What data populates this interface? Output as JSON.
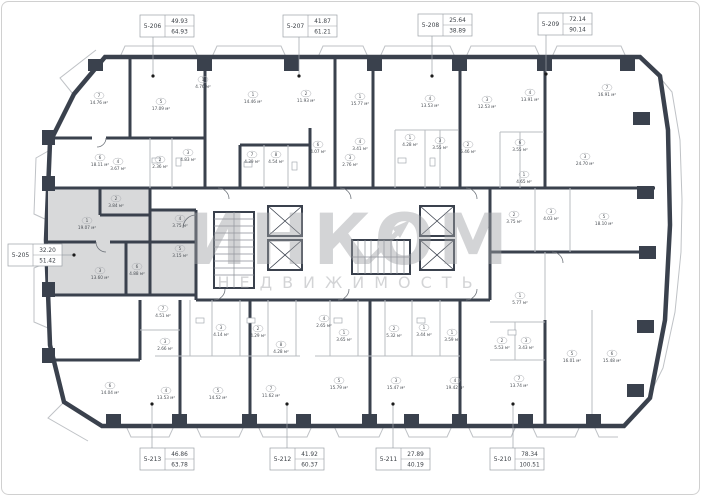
{
  "plan": {
    "area_unit": "м²",
    "watermark": {
      "title": "ИНКОМ",
      "subtitle": "НЕДВИЖИМОСТЬ"
    },
    "highlighted_unit": "5-205",
    "units": [
      {
        "id": "5-205",
        "area1": "32.20",
        "area2": "51.42",
        "side": "left",
        "box": [
          8,
          244
        ],
        "dot": [
          74,
          255
        ]
      },
      {
        "id": "5-206",
        "area1": "49.93",
        "area2": "64.93",
        "side": "top",
        "box": [
          140,
          15
        ],
        "dot": [
          153,
          76
        ]
      },
      {
        "id": "5-207",
        "area1": "41.87",
        "area2": "61.21",
        "side": "top",
        "box": [
          283,
          15
        ],
        "dot": [
          299,
          76
        ]
      },
      {
        "id": "5-208",
        "area1": "25.64",
        "area2": "38.89",
        "side": "top",
        "box": [
          418,
          14
        ],
        "dot": [
          432,
          76
        ]
      },
      {
        "id": "5-209",
        "area1": "72.14",
        "area2": "90.14",
        "side": "top",
        "box": [
          538,
          13
        ],
        "dot": [
          546,
          74
        ]
      },
      {
        "id": "5-213",
        "area1": "46.86",
        "area2": "63.78",
        "side": "bottom",
        "box": [
          140,
          448
        ],
        "dot": [
          152,
          404
        ]
      },
      {
        "id": "5-212",
        "area1": "41.92",
        "area2": "60.37",
        "side": "bottom",
        "box": [
          270,
          448
        ],
        "dot": [
          287,
          404
        ]
      },
      {
        "id": "5-211",
        "area1": "27.89",
        "area2": "40.19",
        "side": "bottom",
        "box": [
          376,
          448
        ],
        "dot": [
          393,
          404
        ]
      },
      {
        "id": "5-210",
        "area1": "78.34",
        "area2": "100.51",
        "side": "bottom",
        "box": [
          490,
          448
        ],
        "dot": [
          513,
          404
        ]
      }
    ],
    "rooms": [
      {
        "n": "1",
        "a": "19.07",
        "x": 87,
        "y": 226
      },
      {
        "n": "2",
        "a": "3.84",
        "x": 116,
        "y": 204
      },
      {
        "n": "3",
        "a": "13.60",
        "x": 100,
        "y": 276
      },
      {
        "n": "6",
        "a": "4.88",
        "x": 137,
        "y": 272
      },
      {
        "n": "4",
        "a": "3.75",
        "x": 180,
        "y": 224
      },
      {
        "n": "5",
        "a": "3.15",
        "x": 180,
        "y": 254
      },
      {
        "n": "7",
        "a": "14.76",
        "x": 99,
        "y": 101
      },
      {
        "n": "5",
        "a": "17.09",
        "x": 161,
        "y": 107
      },
      {
        "n": "1",
        "a": "4.76",
        "x": 203,
        "y": 85
      },
      {
        "n": "6",
        "a": "18.11",
        "x": 100,
        "y": 163
      },
      {
        "n": "4",
        "a": "3.67",
        "x": 118,
        "y": 167
      },
      {
        "n": "2",
        "a": "2.36",
        "x": 160,
        "y": 165
      },
      {
        "n": "3",
        "a": "4.83",
        "x": 188,
        "y": 158
      },
      {
        "n": "1",
        "a": "14.46",
        "x": 253,
        "y": 100
      },
      {
        "n": "2",
        "a": "11.93",
        "x": 306,
        "y": 99
      },
      {
        "n": "7",
        "a": "4.39",
        "x": 252,
        "y": 160
      },
      {
        "n": "8",
        "a": "4.54",
        "x": 276,
        "y": 160
      },
      {
        "n": "6",
        "a": "4.07",
        "x": 318,
        "y": 150
      },
      {
        "n": "3",
        "a": "2.76",
        "x": 350,
        "y": 163
      },
      {
        "n": "1",
        "a": "15.77",
        "x": 360,
        "y": 102
      },
      {
        "n": "4",
        "a": "3.41",
        "x": 360,
        "y": 147
      },
      {
        "n": "1",
        "a": "4.28",
        "x": 410,
        "y": 143
      },
      {
        "n": "4",
        "a": "13.53",
        "x": 430,
        "y": 104
      },
      {
        "n": "3",
        "a": "12.53",
        "x": 487,
        "y": 105
      },
      {
        "n": "4",
        "a": "13.91",
        "x": 530,
        "y": 98
      },
      {
        "n": "3",
        "a": "3.55",
        "x": 440,
        "y": 146
      },
      {
        "n": "2",
        "a": "5.46",
        "x": 468,
        "y": 150
      },
      {
        "n": "6",
        "a": "3.55",
        "x": 520,
        "y": 148
      },
      {
        "n": "7",
        "a": "16.91",
        "x": 607,
        "y": 93
      },
      {
        "n": "3",
        "a": "24.70",
        "x": 585,
        "y": 162
      },
      {
        "n": "1",
        "a": "4.65",
        "x": 524,
        "y": 180
      },
      {
        "n": "2",
        "a": "3.75",
        "x": 514,
        "y": 220
      },
      {
        "n": "3",
        "a": "4.03",
        "x": 551,
        "y": 217
      },
      {
        "n": "5",
        "a": "18.10",
        "x": 604,
        "y": 222
      },
      {
        "n": "6",
        "a": "14.04",
        "x": 110,
        "y": 391
      },
      {
        "n": "7",
        "a": "4.51",
        "x": 163,
        "y": 314
      },
      {
        "n": "3",
        "a": "2.66",
        "x": 165,
        "y": 347
      },
      {
        "n": "4",
        "a": "13.53",
        "x": 166,
        "y": 396
      },
      {
        "n": "3",
        "a": "4.14",
        "x": 221,
        "y": 333
      },
      {
        "n": "2",
        "a": "4.29",
        "x": 258,
        "y": 334
      },
      {
        "n": "8",
        "a": "4.28",
        "x": 281,
        "y": 350
      },
      {
        "n": "5",
        "a": "14.52",
        "x": 218,
        "y": 396
      },
      {
        "n": "7",
        "a": "11.62",
        "x": 271,
        "y": 394
      },
      {
        "n": "4",
        "a": "2.65",
        "x": 324,
        "y": 324
      },
      {
        "n": "1",
        "a": "3.65",
        "x": 344,
        "y": 338
      },
      {
        "n": "2",
        "a": "5.32",
        "x": 394,
        "y": 334
      },
      {
        "n": "5",
        "a": "15.79",
        "x": 339,
        "y": 386
      },
      {
        "n": "3",
        "a": "15.47",
        "x": 396,
        "y": 386
      },
      {
        "n": "1",
        "a": "3.44",
        "x": 424,
        "y": 333
      },
      {
        "n": "1",
        "a": "3.59",
        "x": 452,
        "y": 338
      },
      {
        "n": "4",
        "a": "19.42",
        "x": 455,
        "y": 386
      },
      {
        "n": "1",
        "a": "5.77",
        "x": 520,
        "y": 301
      },
      {
        "n": "2",
        "a": "5.53",
        "x": 502,
        "y": 346
      },
      {
        "n": "3",
        "a": "3.43",
        "x": 526,
        "y": 346
      },
      {
        "n": "7",
        "a": "13.74",
        "x": 519,
        "y": 384
      },
      {
        "n": "5",
        "a": "16.01",
        "x": 572,
        "y": 359
      },
      {
        "n": "6",
        "a": "15.48",
        "x": 612,
        "y": 359
      }
    ]
  }
}
